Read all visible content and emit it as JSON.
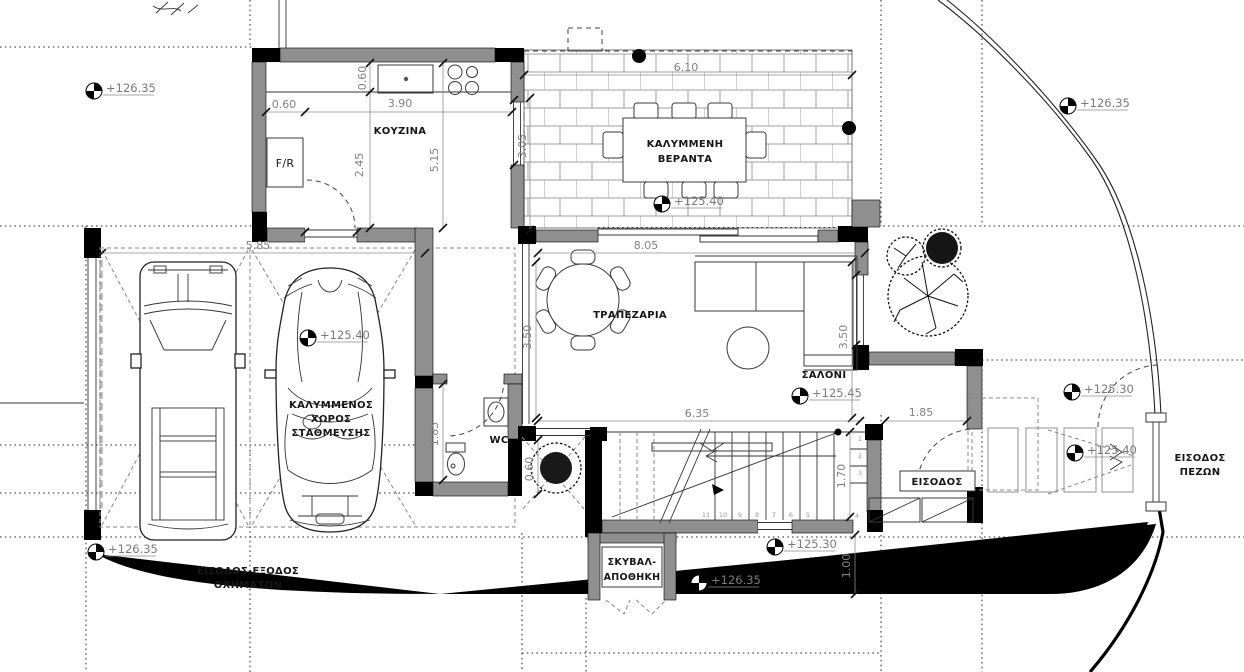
{
  "plan": {
    "rooms": {
      "kitchen": {
        "label": "ΚΟΥΖΙΝΑ",
        "fridge": "F/R"
      },
      "veranda": {
        "line1": "ΚΑΛΥΜΜΕΝΗ",
        "line2": "ΒΕΡΑΝΤΑ"
      },
      "dining": {
        "label": "ΤΡΑΠΕΖΑΡΙΑ"
      },
      "living": {
        "label": "ΣΑΛΟΝΙ"
      },
      "wc": {
        "label": "WC"
      },
      "parking": {
        "line1": "ΚΑΛΥΜΜΕΝΟΣ",
        "line2": "ΧΩΡΟΣ",
        "line3": "ΣΤΑΘΜΕΥΣΗΣ"
      },
      "entrance": {
        "label": "ΕΙΣΟΔΟΣ"
      },
      "garbage": {
        "line1": "ΣΚΥΒΑΛ-",
        "line2": "ΑΠΟΘΗΚΗ"
      },
      "vehicle_access": {
        "line1": "ΕΙΣΟΔΟΣ-ΕΞΟΔΟΣ",
        "line2": "ΟΧΗΜΑΤΩΝ"
      },
      "pedestrian_entrance": {
        "line1": "ΕΙΣΟΔΟΣ",
        "line2": "ΠΕΖΩΝ"
      }
    },
    "dimensions": {
      "fridge_depth": "0.60",
      "kitchen_width": "3.90",
      "counter_depth": "0.60",
      "kitchen_inner_depth": "2.45",
      "kitchen_depth": "5.15",
      "veranda_width": "6.10",
      "veranda_depth": "3.05",
      "carport_width": "5.85",
      "living_width_top": "8.05",
      "living_depth_left": "3.50",
      "living_depth_right": "3.50",
      "living_width_bottom": "6.35",
      "entrance_width": "1.85",
      "wc_depth": "1.85",
      "stair_width": "1.70",
      "side_path_width": "1.00",
      "planter_width": "0.60"
    },
    "elevations": {
      "e1": "+126.35",
      "e2": "+126.35",
      "e3": "+125.40",
      "e4": "+125.40",
      "e5": "+125.45",
      "e6": "+125.30",
      "e7": "+126.35",
      "e8": "+126.35",
      "e9": "+125.30",
      "e10": "+125.40"
    },
    "stairs": {
      "run": [
        "11",
        "10",
        "9",
        "8",
        "7",
        "6",
        "5"
      ],
      "turn": [
        "1",
        "2",
        "3",
        "4"
      ]
    },
    "colors": {
      "wall": "#8f8f8f",
      "dim_text": "#828282",
      "elevation_text": "#7a7a7a",
      "label_text": "#161616",
      "brick_joint": "#9f9f9f"
    }
  }
}
